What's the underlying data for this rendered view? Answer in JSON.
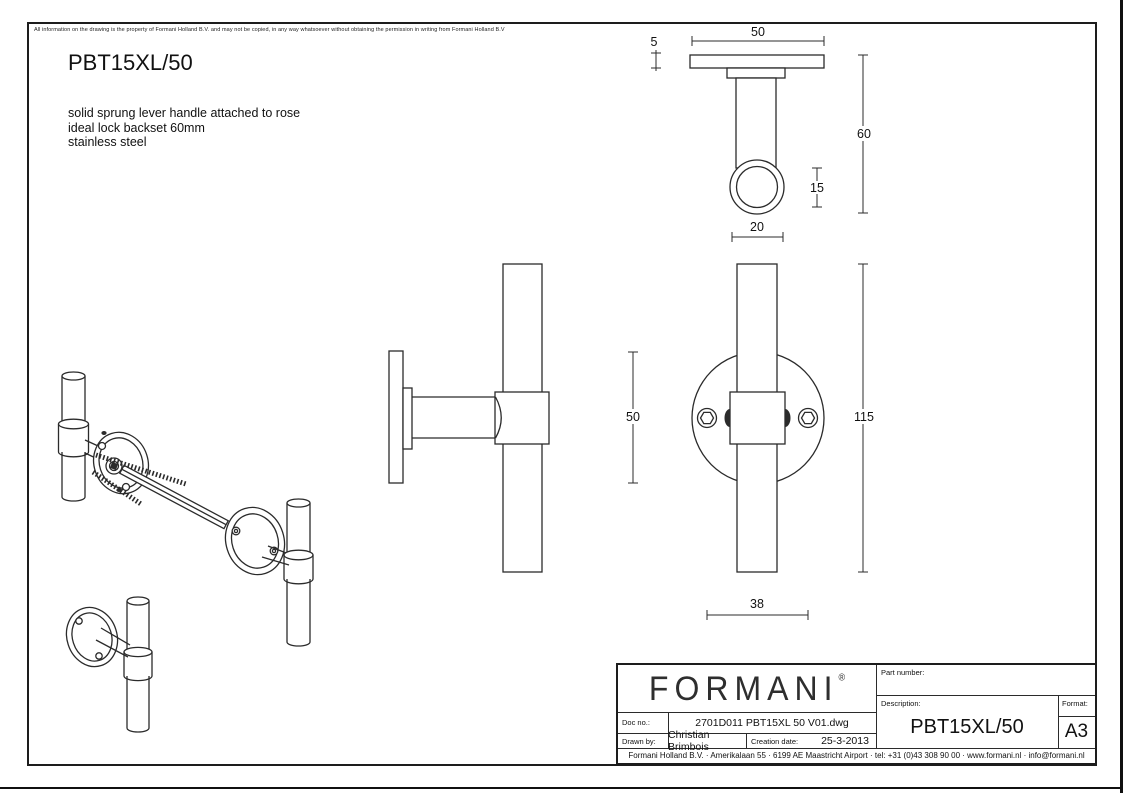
{
  "page": {
    "disclaimer": "All information on the drawing is the property of Formani Holland B.V. and may not be copied, in any way whatsoever without obtaining the permission in writing from Formani Holland B.V",
    "title": "PBT15XL/50",
    "description_lines": [
      "solid sprung lever handle attached to rose",
      "ideal lock backset 60mm",
      "stainless steel"
    ]
  },
  "dimensions": {
    "top_view": {
      "rose_width": "50",
      "rose_thickness": "5",
      "projection": "60",
      "tube_diameter": "15",
      "end_cap_diameter": "20"
    },
    "front_view": {
      "rose_diameter": "50",
      "handle_length": "115",
      "screw_spacing": "38"
    }
  },
  "title_block": {
    "logo": "FORMANI",
    "logo_mark": "®",
    "doc_no_label": "Doc no.:",
    "doc_no": "2701D011 PBT15XL 50 V01.dwg",
    "drawn_by_label": "Drawn by:",
    "drawn_by": "Christian Brimbois",
    "creation_date_label": "Creation date:",
    "creation_date": "25-3-2013",
    "part_number_label": "Part number:",
    "description_label": "Description:",
    "description": "PBT15XL/50",
    "format_label": "Format:",
    "format": "A3",
    "footer": "Formani Holland B.V. · Amerikalaan 55 · 6199 AE Maastricht Airport · tel: +31 (0)43 308 90 00 · www.formani.nl · info@formani.nl"
  },
  "colors": {
    "line": "#2b2b2b",
    "background": "#ffffff"
  }
}
